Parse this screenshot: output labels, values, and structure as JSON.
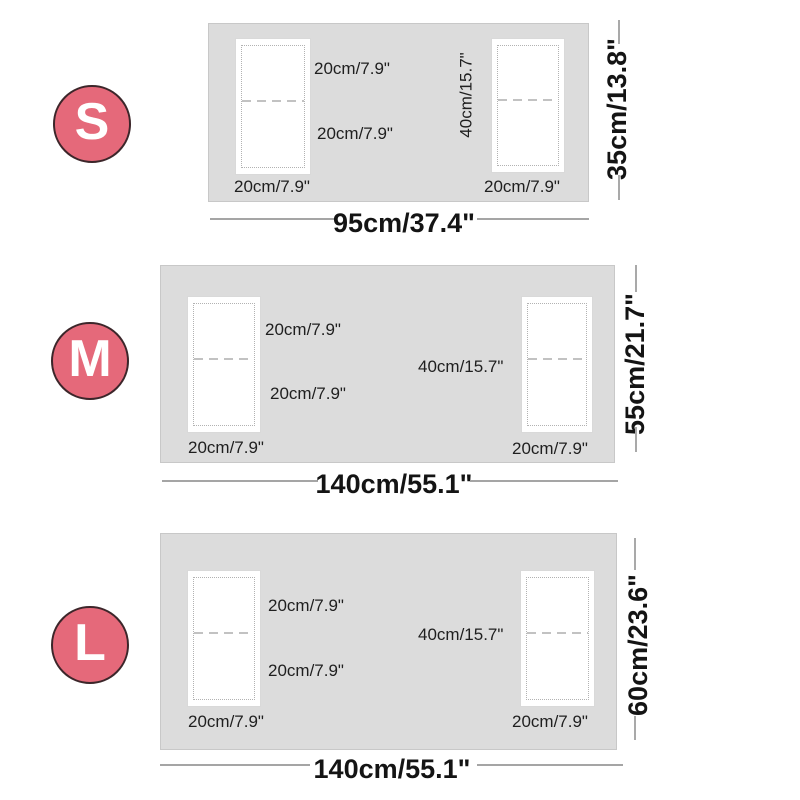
{
  "colors": {
    "badge_fill": "#e5697a",
    "badge_border": "#3c262a",
    "table_fill": "#dcdcdc",
    "table_border": "#c8c8c8",
    "stitch_dots": "#b2b2b2",
    "label_text": "#1f1f1f",
    "dimension_text": "#141414",
    "dimension_line": "#a5a5a5"
  },
  "diagrams": [
    {
      "size_letter": "S",
      "mat_top_half": "20cm/7.9\"",
      "mat_bottom_half": "20cm/7.9\"",
      "mat_length": "40cm/15.7\"",
      "left_mat_width": "20cm/7.9\"",
      "right_mat_width": "20cm/7.9\"",
      "table_width": "95cm/37.4\"",
      "table_height": "35cm/13.8\""
    },
    {
      "size_letter": "M",
      "mat_top_half": "20cm/7.9\"",
      "mat_bottom_half": "20cm/7.9\"",
      "mat_length": "40cm/15.7\"",
      "left_mat_width": "20cm/7.9\"",
      "right_mat_width": "20cm/7.9\"",
      "table_width": "140cm/55.1\"",
      "table_height": "55cm/21.7\""
    },
    {
      "size_letter": "L",
      "mat_top_half": "20cm/7.9\"",
      "mat_bottom_half": "20cm/7.9\"",
      "mat_length": "40cm/15.7\"",
      "left_mat_width": "20cm/7.9\"",
      "right_mat_width": "20cm/7.9\"",
      "table_width": "140cm/55.1\"",
      "table_height": "60cm/23.6\""
    }
  ]
}
